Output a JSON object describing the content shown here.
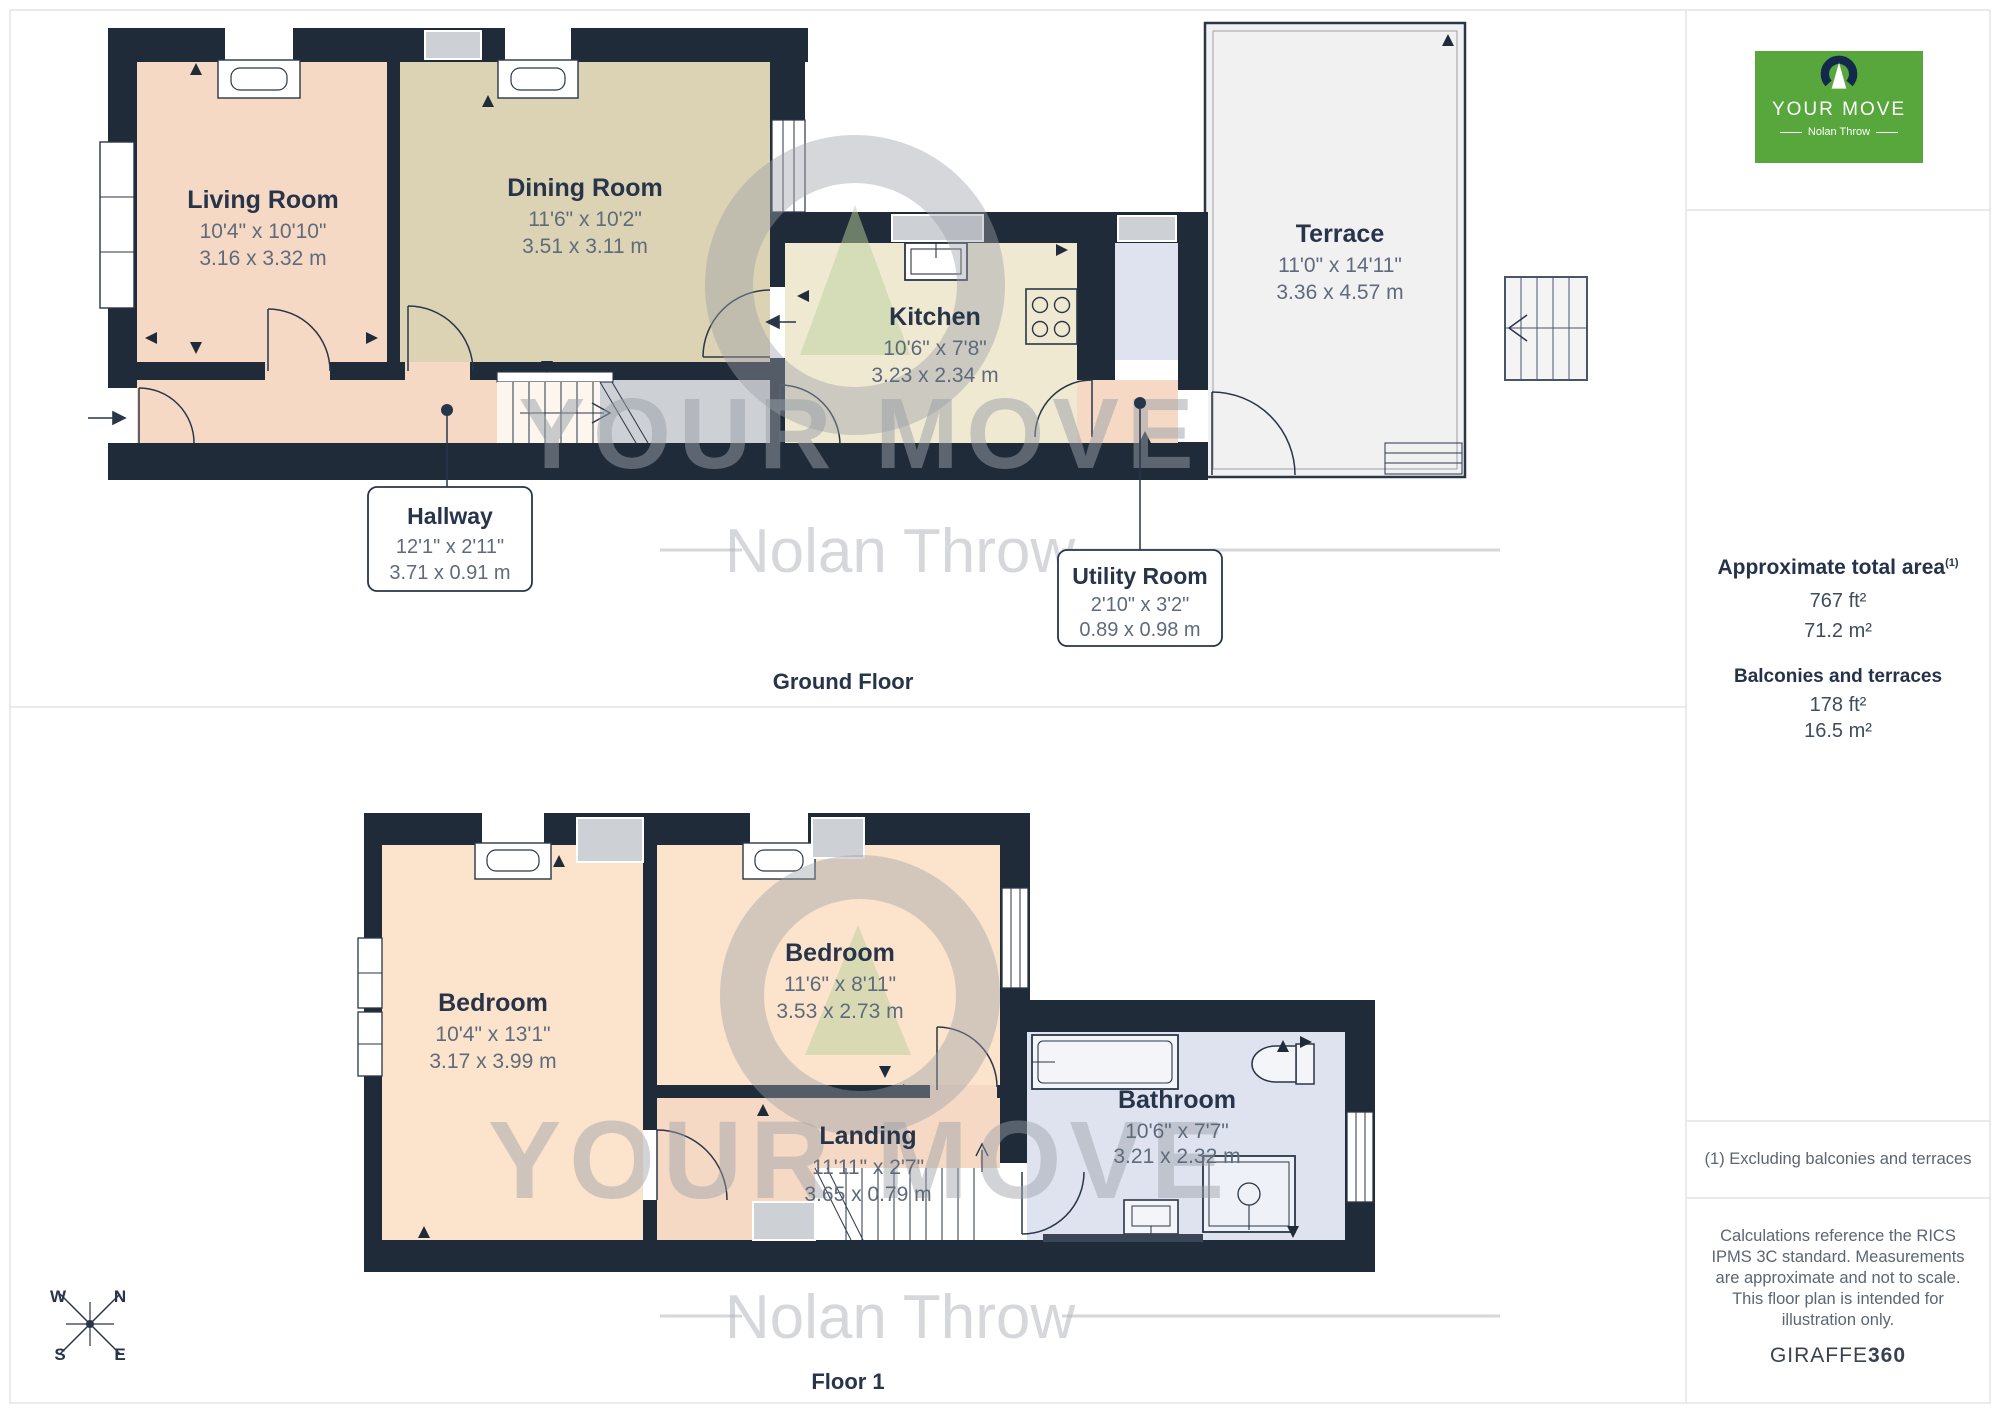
{
  "watermark": {
    "line1": "YOUR MOVE",
    "line2": "Nolan Throw"
  },
  "ground_floor": {
    "section_label": "Ground Floor",
    "rooms": [
      {
        "name": "Living Room",
        "imperial": "10'4\" x 10'10\"",
        "metric": "3.16 x 3.32 m"
      },
      {
        "name": "Dining Room",
        "imperial": "11'6\" x 10'2\"",
        "metric": "3.51 x 3.11 m"
      },
      {
        "name": "Kitchen",
        "imperial": "10'6\" x 7'8\"",
        "metric": "3.23 x 2.34 m"
      },
      {
        "name": "Terrace",
        "imperial": "11'0\" x 14'11\"",
        "metric": "3.36 x 4.57 m"
      }
    ],
    "callouts": [
      {
        "name": "Hallway",
        "imperial": "12'1\" x 2'11\"",
        "metric": "3.71 x 0.91 m"
      },
      {
        "name": "Utility Room",
        "imperial": "2'10\" x 3'2\"",
        "metric": "0.89 x 0.98 m"
      }
    ]
  },
  "floor1": {
    "section_label": "Floor 1",
    "rooms": [
      {
        "name": "Bedroom",
        "imperial": "10'4\" x 13'1\"",
        "metric": "3.17 x 3.99 m"
      },
      {
        "name": "Bedroom",
        "imperial": "11'6\" x 8'11\"",
        "metric": "3.53 x 2.73 m"
      },
      {
        "name": "Landing",
        "imperial": "11'11\" x 2'7\"",
        "metric": "3.65 x 0.79 m"
      },
      {
        "name": "Bathroom",
        "imperial": "10'6\" x 7'7\"",
        "metric": "3.21 x 2.32 m"
      }
    ]
  },
  "compass": {
    "n": "N",
    "e": "E",
    "s": "S",
    "w": "W"
  },
  "sidebar": {
    "logo_title": "YOUR MOVE",
    "logo_subtitle": "Nolan Throw",
    "area_title": "Approximate total area",
    "area_sup": "(1)",
    "area_ft": "767 ft²",
    "area_m": "71.2 m²",
    "balconies_title": "Balconies and terraces",
    "balconies_ft": "178 ft²",
    "balconies_m": "16.5 m²",
    "footnote": "(1) Excluding balconies and terraces",
    "disclaimer": "Calculations reference the RICS IPMS 3C standard. Measurements are approximate and not to scale. This floor plan is intended for illustration only.",
    "brand_a": "GIRAFFE",
    "brand_b": "360"
  },
  "colors": {
    "wall": "#202b39",
    "living": "#f5d9c5",
    "dining": "#dbd3b4",
    "kitchen": "#f0e9d2",
    "bedroom": "#fbe3cc",
    "wet_room": "#dee3ef",
    "terrace": "#f1f1f2",
    "gray_inset": "#cdd1d6",
    "brand_green": "#57a73c",
    "title_text": "#27344a",
    "dim_text": "#5f6b7c"
  }
}
